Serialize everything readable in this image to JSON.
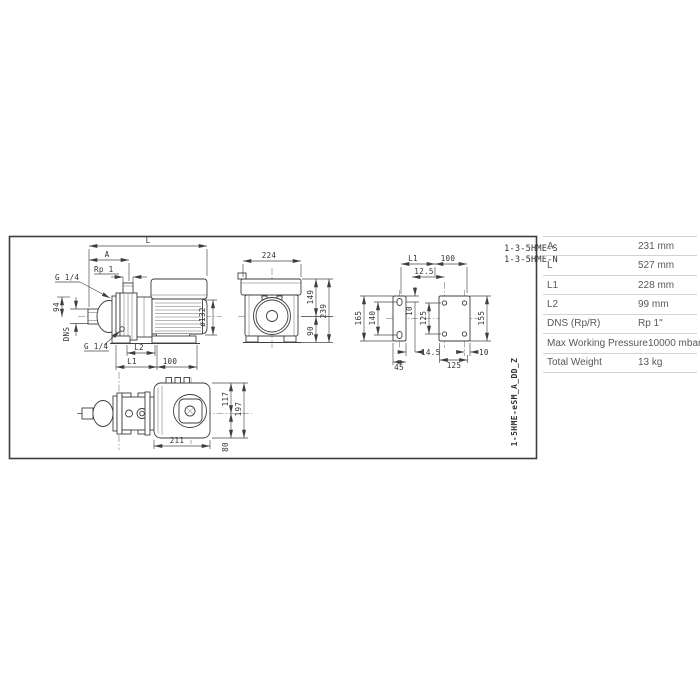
{
  "drawing": {
    "models": {
      "top": "1-3-5HME-S",
      "bottom": "1-3-5HME-N",
      "side_code": "1-5HME-eSM_A_DD_Z"
    },
    "labels": {
      "L": "L",
      "A": "A",
      "rp1": "Rp 1",
      "g14": "G 1/4",
      "d94": "94",
      "dns": "DNS",
      "L2": "L2",
      "L1": "L1",
      "d100": "100",
      "d132": "ø132",
      "d224": "224",
      "d149": "149",
      "d239": "239",
      "d90": "90",
      "d12_5": "12.5",
      "d10": "10",
      "d165": "165",
      "d140": "140",
      "d125": "125",
      "d155": "155",
      "d14_5": "14.5",
      "d45": "45",
      "d211": "211",
      "d117": "117",
      "d197": "197",
      "d80": "80"
    }
  },
  "table": {
    "rows": [
      {
        "label": "A",
        "value": "231 mm"
      },
      {
        "label": "L",
        "value": "527 mm"
      },
      {
        "label": "L1",
        "value": "228 mm"
      },
      {
        "label": "L2",
        "value": "99 mm"
      },
      {
        "label": "DNS (Rp/R)",
        "value": "Rp 1\""
      },
      {
        "label": "Max Working Pressure",
        "value": "10000 mbar"
      },
      {
        "label": "Total Weight",
        "value": "13 kg"
      }
    ]
  }
}
